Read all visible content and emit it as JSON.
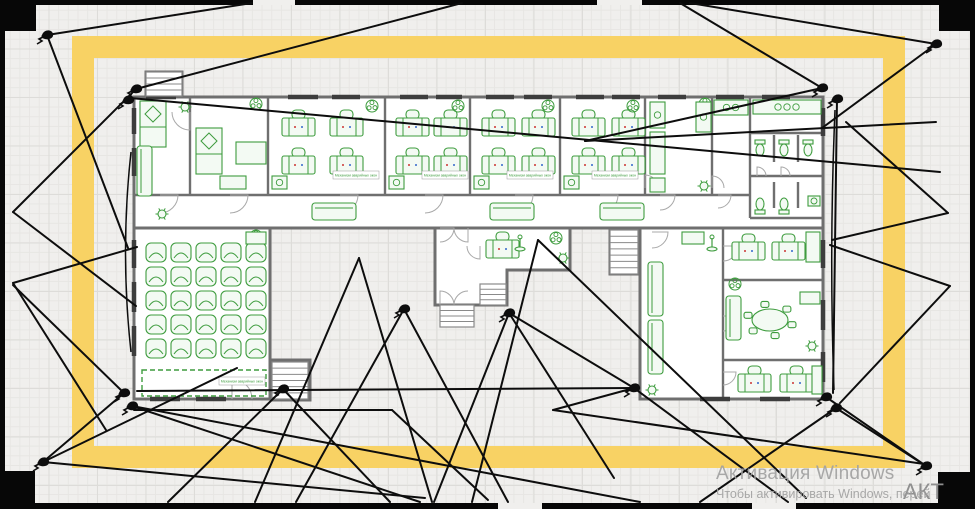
{
  "watermark": {
    "title": "Активация Windows",
    "subtitle": "Чтобы активировать Windows, перей",
    "stamp": "АКТ"
  },
  "colors": {
    "canvas_bg": "#f0efed",
    "grid": "#e7e6e3",
    "fence_black": "#070707",
    "yellow_band": "#f8d264",
    "wall_gray": "#6f6f6f",
    "window_dark": "#3d3d3d",
    "door_arc": "#a8a8a8",
    "furniture_green": "#3e9c3e",
    "furniture_fill": "#f3faf3",
    "cone_black": "#0d0d0d",
    "mark_red": "#cc3333",
    "mark_blue": "#3366cc"
  },
  "frame": {
    "x": 83,
    "y": 47,
    "w": 811,
    "h": 410,
    "thickness": 22
  },
  "fence": {
    "bars": [
      [
        0,
        0,
        975,
        5
      ],
      [
        0,
        503,
        975,
        6
      ],
      [
        0,
        0,
        5,
        509
      ],
      [
        970,
        0,
        5,
        509
      ]
    ],
    "corners": [
      [
        0,
        0,
        36,
        31
      ],
      [
        939,
        0,
        36,
        31
      ],
      [
        5,
        471,
        30,
        33
      ],
      [
        938,
        472,
        37,
        37
      ]
    ],
    "gaps_top": [
      [
        253,
        0,
        42,
        5
      ],
      [
        597,
        0,
        45,
        5
      ]
    ],
    "gaps_bottom": [
      [
        498,
        503,
        44,
        6
      ],
      [
        752,
        503,
        44,
        6
      ]
    ]
  },
  "plan": {
    "label_text": "Механизм аварийных окон",
    "buildings": {
      "rects": [
        [
          134,
          97,
          689,
          131
        ],
        [
          134,
          228,
          136,
          171
        ],
        [
          640,
          228,
          183,
          171
        ],
        [
          272,
          360,
          38,
          40
        ],
        [
          610,
          228,
          28,
          46
        ],
        [
          146,
          72,
          36,
          25
        ]
      ],
      "paths": [
        "M435,228 L570,228 L570,270 L507,270 L507,305 L435,305 Z"
      ]
    },
    "inner_walls": [
      [
        134,
        195,
        750,
        195
      ],
      [
        190,
        97,
        190,
        195
      ],
      [
        268,
        97,
        268,
        195
      ],
      [
        385,
        97,
        385,
        195
      ],
      [
        470,
        97,
        470,
        195
      ],
      [
        560,
        97,
        560,
        195
      ],
      [
        645,
        97,
        645,
        195
      ],
      [
        712,
        97,
        712,
        195
      ],
      [
        750,
        97,
        750,
        218
      ],
      [
        750,
        133,
        823,
        133
      ],
      [
        750,
        176,
        823,
        176
      ],
      [
        750,
        218,
        823,
        218
      ],
      [
        774,
        135,
        774,
        162
      ],
      [
        798,
        135,
        798,
        162
      ],
      [
        774,
        182,
        774,
        208
      ],
      [
        798,
        182,
        798,
        208
      ],
      [
        723,
        228,
        723,
        399
      ],
      [
        723,
        280,
        823,
        280
      ],
      [
        723,
        360,
        823,
        360
      ]
    ],
    "windows": [
      [
        146,
        97,
        176,
        97
      ],
      [
        288,
        97,
        318,
        97
      ],
      [
        332,
        97,
        360,
        97
      ],
      [
        400,
        97,
        428,
        97
      ],
      [
        436,
        97,
        462,
        97
      ],
      [
        486,
        97,
        514,
        97
      ],
      [
        524,
        97,
        552,
        97
      ],
      [
        576,
        97,
        604,
        97
      ],
      [
        612,
        97,
        640,
        97
      ],
      [
        658,
        97,
        686,
        97
      ],
      [
        716,
        97,
        744,
        97
      ],
      [
        762,
        97,
        790,
        97
      ],
      [
        134,
        108,
        134,
        134
      ],
      [
        134,
        148,
        134,
        176
      ],
      [
        134,
        240,
        134,
        268
      ],
      [
        134,
        282,
        134,
        312
      ],
      [
        134,
        326,
        134,
        356
      ],
      [
        150,
        399,
        180,
        399
      ],
      [
        196,
        399,
        226,
        399
      ],
      [
        823,
        108,
        823,
        136
      ],
      [
        823,
        240,
        823,
        268
      ],
      [
        823,
        300,
        823,
        330
      ],
      [
        823,
        352,
        823,
        382
      ],
      [
        760,
        399,
        790,
        399
      ],
      [
        700,
        399,
        730,
        399
      ]
    ],
    "doors": [
      [
        160,
        195,
        18,
        0
      ],
      [
        230,
        195,
        18,
        0
      ],
      [
        340,
        195,
        18,
        0
      ],
      [
        425,
        195,
        18,
        0
      ],
      [
        515,
        195,
        18,
        0
      ],
      [
        600,
        195,
        18,
        0
      ],
      [
        660,
        195,
        15,
        0
      ],
      [
        718,
        195,
        13,
        0
      ],
      [
        232,
        399,
        20,
        3
      ],
      [
        440,
        228,
        14,
        0
      ],
      [
        468,
        228,
        14,
        1
      ],
      [
        440,
        305,
        14,
        3
      ],
      [
        468,
        305,
        14,
        2
      ],
      [
        480,
        246,
        13,
        1
      ],
      [
        652,
        232,
        16,
        0
      ],
      [
        723,
        246,
        15,
        0
      ],
      [
        723,
        316,
        15,
        0
      ],
      [
        723,
        372,
        13,
        0
      ],
      [
        757,
        176,
        9,
        3
      ],
      [
        781,
        176,
        9,
        3
      ],
      [
        190,
        112,
        18,
        1
      ],
      [
        645,
        188,
        13,
        3
      ],
      [
        712,
        188,
        12,
        3
      ]
    ],
    "desks": [
      [
        282,
        110
      ],
      [
        330,
        110
      ],
      [
        282,
        148
      ],
      [
        330,
        148
      ],
      [
        396,
        110
      ],
      [
        434,
        110
      ],
      [
        396,
        148
      ],
      [
        434,
        148
      ],
      [
        482,
        110
      ],
      [
        522,
        110
      ],
      [
        482,
        148
      ],
      [
        522,
        148
      ],
      [
        572,
        110
      ],
      [
        612,
        110
      ],
      [
        572,
        148
      ],
      [
        612,
        148
      ],
      [
        486,
        232
      ],
      [
        732,
        234
      ],
      [
        772,
        234
      ],
      [
        738,
        366
      ],
      [
        780,
        366
      ]
    ],
    "classroom_chairs": {
      "x0": 146,
      "y0": 243,
      "dx": 25,
      "dy": 24,
      "cols": 5,
      "rows": 5
    },
    "furniture": [
      {
        "t": "bed",
        "x": 140,
        "y": 101
      },
      {
        "t": "bed",
        "x": 196,
        "y": 128
      },
      {
        "t": "sofaV",
        "x": 137,
        "y": 146,
        "h": 50
      },
      {
        "t": "sofaV",
        "x": 648,
        "y": 262,
        "h": 54
      },
      {
        "t": "sofaV",
        "x": 648,
        "y": 320,
        "h": 54
      },
      {
        "t": "sofaV",
        "x": 726,
        "y": 296,
        "h": 44
      },
      {
        "t": "plant",
        "x": 185,
        "y": 107
      },
      {
        "t": "plant",
        "x": 162,
        "y": 214
      },
      {
        "t": "plant",
        "x": 704,
        "y": 186
      },
      {
        "t": "plant",
        "x": 652,
        "y": 390
      },
      {
        "t": "plant",
        "x": 563,
        "y": 258
      },
      {
        "t": "plant",
        "x": 812,
        "y": 346
      },
      {
        "t": "fan",
        "x": 256,
        "y": 104
      },
      {
        "t": "fan",
        "x": 372,
        "y": 106
      },
      {
        "t": "fan",
        "x": 458,
        "y": 106
      },
      {
        "t": "fan",
        "x": 548,
        "y": 106
      },
      {
        "t": "fan",
        "x": 633,
        "y": 106
      },
      {
        "t": "fan",
        "x": 705,
        "y": 104
      },
      {
        "t": "fan",
        "x": 256,
        "y": 236
      },
      {
        "t": "fan",
        "x": 556,
        "y": 238
      },
      {
        "t": "fan",
        "x": 735,
        "y": 284
      },
      {
        "t": "table",
        "x": 236,
        "y": 142,
        "w": 30,
        "h": 22
      },
      {
        "t": "table",
        "x": 682,
        "y": 232,
        "w": 22,
        "h": 12
      },
      {
        "t": "table",
        "x": 806,
        "y": 232,
        "w": 14,
        "h": 30
      },
      {
        "t": "table",
        "x": 800,
        "y": 292,
        "w": 20,
        "h": 12
      },
      {
        "t": "table",
        "x": 812,
        "y": 366,
        "w": 10,
        "h": 28
      },
      {
        "t": "table",
        "x": 246,
        "y": 232,
        "w": 20,
        "h": 12
      },
      {
        "t": "counter",
        "x": 272,
        "y": 176,
        "w": 15,
        "h": 13,
        "n": 1
      },
      {
        "t": "counter",
        "x": 389,
        "y": 176,
        "w": 15,
        "h": 13,
        "n": 1
      },
      {
        "t": "counter",
        "x": 474,
        "y": 176,
        "w": 15,
        "h": 13,
        "n": 1
      },
      {
        "t": "counter",
        "x": 564,
        "y": 176,
        "w": 15,
        "h": 13,
        "n": 1
      },
      {
        "t": "counter",
        "x": 650,
        "y": 102,
        "w": 15,
        "h": 26,
        "n": 1
      },
      {
        "t": "counter",
        "x": 650,
        "y": 132,
        "w": 15,
        "h": 42,
        "n": 0
      },
      {
        "t": "counter",
        "x": 650,
        "y": 178,
        "w": 15,
        "h": 14,
        "n": 0
      },
      {
        "t": "counter",
        "x": 696,
        "y": 102,
        "w": 15,
        "h": 30,
        "n": 1
      },
      {
        "t": "counter",
        "x": 714,
        "y": 100,
        "w": 34,
        "h": 15,
        "n": 2
      },
      {
        "t": "counter",
        "x": 753,
        "y": 100,
        "w": 68,
        "h": 14,
        "n": 3
      },
      {
        "t": "counter",
        "x": 220,
        "y": 176,
        "w": 26,
        "h": 13,
        "n": 0
      },
      {
        "t": "bench",
        "x": 312,
        "y": 203,
        "w": 44
      },
      {
        "t": "bench",
        "x": 490,
        "y": 203,
        "w": 44
      },
      {
        "t": "bench",
        "x": 600,
        "y": 203,
        "w": 44
      },
      {
        "t": "toiletD",
        "x": 760,
        "y": 140
      },
      {
        "t": "toiletD",
        "x": 784,
        "y": 140
      },
      {
        "t": "toiletD",
        "x": 808,
        "y": 140
      },
      {
        "t": "toiletU",
        "x": 760,
        "y": 198
      },
      {
        "t": "toiletU",
        "x": 784,
        "y": 198
      },
      {
        "t": "sink",
        "x": 808,
        "y": 196
      },
      {
        "t": "coat",
        "x": 520,
        "y": 238
      },
      {
        "t": "coat",
        "x": 712,
        "y": 238
      },
      {
        "t": "oval",
        "x": 770,
        "y": 320
      },
      {
        "t": "stairs",
        "x": 146,
        "y": 72,
        "w": 36,
        "h": 24,
        "n": 4
      },
      {
        "t": "stairs",
        "x": 272,
        "y": 362,
        "w": 36,
        "h": 37,
        "n": 6
      },
      {
        "t": "stairs",
        "x": 610,
        "y": 230,
        "w": 28,
        "h": 44,
        "n": 7
      },
      {
        "t": "stairs",
        "x": 480,
        "y": 284,
        "w": 26,
        "h": 21,
        "n": 4
      },
      {
        "t": "stairs",
        "x": 440,
        "y": 305,
        "w": 34,
        "h": 22,
        "n": 4
      },
      {
        "t": "dash",
        "x": 142,
        "y": 370,
        "w": 124,
        "h": 26
      }
    ],
    "labels": [
      {
        "x": 356,
        "y": 171
      },
      {
        "x": 445,
        "y": 171
      },
      {
        "x": 530,
        "y": 171
      },
      {
        "x": 615,
        "y": 171
      },
      {
        "x": 242,
        "y": 377
      }
    ],
    "cameras": [
      [
        47,
        35
      ],
      [
        136,
        89
      ],
      [
        128,
        100
      ],
      [
        822,
        88
      ],
      [
        837,
        99
      ],
      [
        936,
        44
      ],
      [
        124,
        393
      ],
      [
        132,
        406
      ],
      [
        283,
        389
      ],
      [
        404,
        309
      ],
      [
        509,
        313
      ],
      [
        634,
        388
      ],
      [
        826,
        397
      ],
      [
        836,
        408
      ],
      [
        43,
        462
      ],
      [
        926,
        466
      ]
    ],
    "cones": [
      [
        [
          47,
          35
        ],
        [
          252,
          3
        ]
      ],
      [
        [
          47,
          35
        ],
        [
          128,
          248
        ]
      ],
      [
        [
          136,
          89
        ],
        [
          462,
          3
        ]
      ],
      [
        [
          136,
          89
        ],
        [
          13,
          212
        ]
      ],
      [
        [
          13,
          212
        ],
        [
          136,
          306
        ]
      ],
      [
        [
          13,
          283
        ],
        [
          137,
          247
        ]
      ],
      [
        [
          13,
          283
        ],
        [
          106,
          430
        ]
      ],
      [
        [
          130,
          98
        ],
        [
          940,
          172
        ]
      ],
      [
        [
          822,
          88
        ],
        [
          680,
          3
        ]
      ],
      [
        [
          822,
          88
        ],
        [
          585,
          141
        ]
      ],
      [
        [
          585,
          141
        ],
        [
          936,
          122
        ]
      ],
      [
        [
          936,
          44
        ],
        [
          822,
          128
        ]
      ],
      [
        [
          936,
          44
        ],
        [
          690,
          3
        ]
      ],
      [
        [
          837,
          99
        ],
        [
          833,
          393
        ]
      ],
      [
        [
          948,
          213
        ],
        [
          832,
          240
        ]
      ],
      [
        [
          948,
          213
        ],
        [
          846,
          122
        ]
      ],
      [
        [
          950,
          286
        ],
        [
          830,
          245
        ]
      ],
      [
        [
          950,
          286
        ],
        [
          840,
          403
        ]
      ],
      [
        [
          124,
          393
        ],
        [
          43,
          462
        ]
      ],
      [
        [
          124,
          393
        ],
        [
          13,
          285
        ]
      ],
      [
        [
          132,
          406
        ],
        [
          420,
          502
        ]
      ],
      [
        [
          132,
          406
        ],
        [
          640,
          502
        ]
      ],
      [
        [
          43,
          462
        ],
        [
          237,
          368
        ]
      ],
      [
        [
          43,
          462
        ],
        [
          425,
          498
        ]
      ],
      [
        [
          283,
          389
        ],
        [
          390,
          502
        ]
      ],
      [
        [
          283,
          389
        ],
        [
          168,
          502
        ]
      ],
      [
        [
          404,
          309
        ],
        [
          296,
          502
        ]
      ],
      [
        [
          404,
          309
        ],
        [
          508,
          502
        ]
      ],
      [
        [
          509,
          313
        ],
        [
          434,
          502
        ]
      ],
      [
        [
          509,
          313
        ],
        [
          614,
          478
        ]
      ],
      [
        [
          359,
          258
        ],
        [
          255,
          502
        ]
      ],
      [
        [
          359,
          258
        ],
        [
          432,
          502
        ]
      ],
      [
        [
          538,
          240
        ],
        [
          472,
          502
        ]
      ],
      [
        [
          538,
          240
        ],
        [
          806,
          498
        ]
      ],
      [
        [
          134,
          410
        ],
        [
          392,
          410
        ]
      ],
      [
        [
          392,
          410
        ],
        [
          488,
          500
        ]
      ],
      [
        [
          634,
          388
        ],
        [
          137,
          391
        ]
      ],
      [
        [
          634,
          388
        ],
        [
          509,
          313
        ]
      ],
      [
        [
          634,
          388
        ],
        [
          788,
          502
        ]
      ],
      [
        [
          634,
          388
        ],
        [
          553,
          410
        ]
      ],
      [
        [
          553,
          410
        ],
        [
          924,
          464
        ]
      ],
      [
        [
          826,
          397
        ],
        [
          926,
          466
        ]
      ],
      [
        [
          836,
          408
        ],
        [
          700,
          502
        ]
      ],
      [
        [
          836,
          408
        ],
        [
          926,
          466
        ]
      ]
    ],
    "arcs": [
      "M131,152 Q120,252 131,352",
      "M835,110 Q829,250 834,390"
    ]
  }
}
